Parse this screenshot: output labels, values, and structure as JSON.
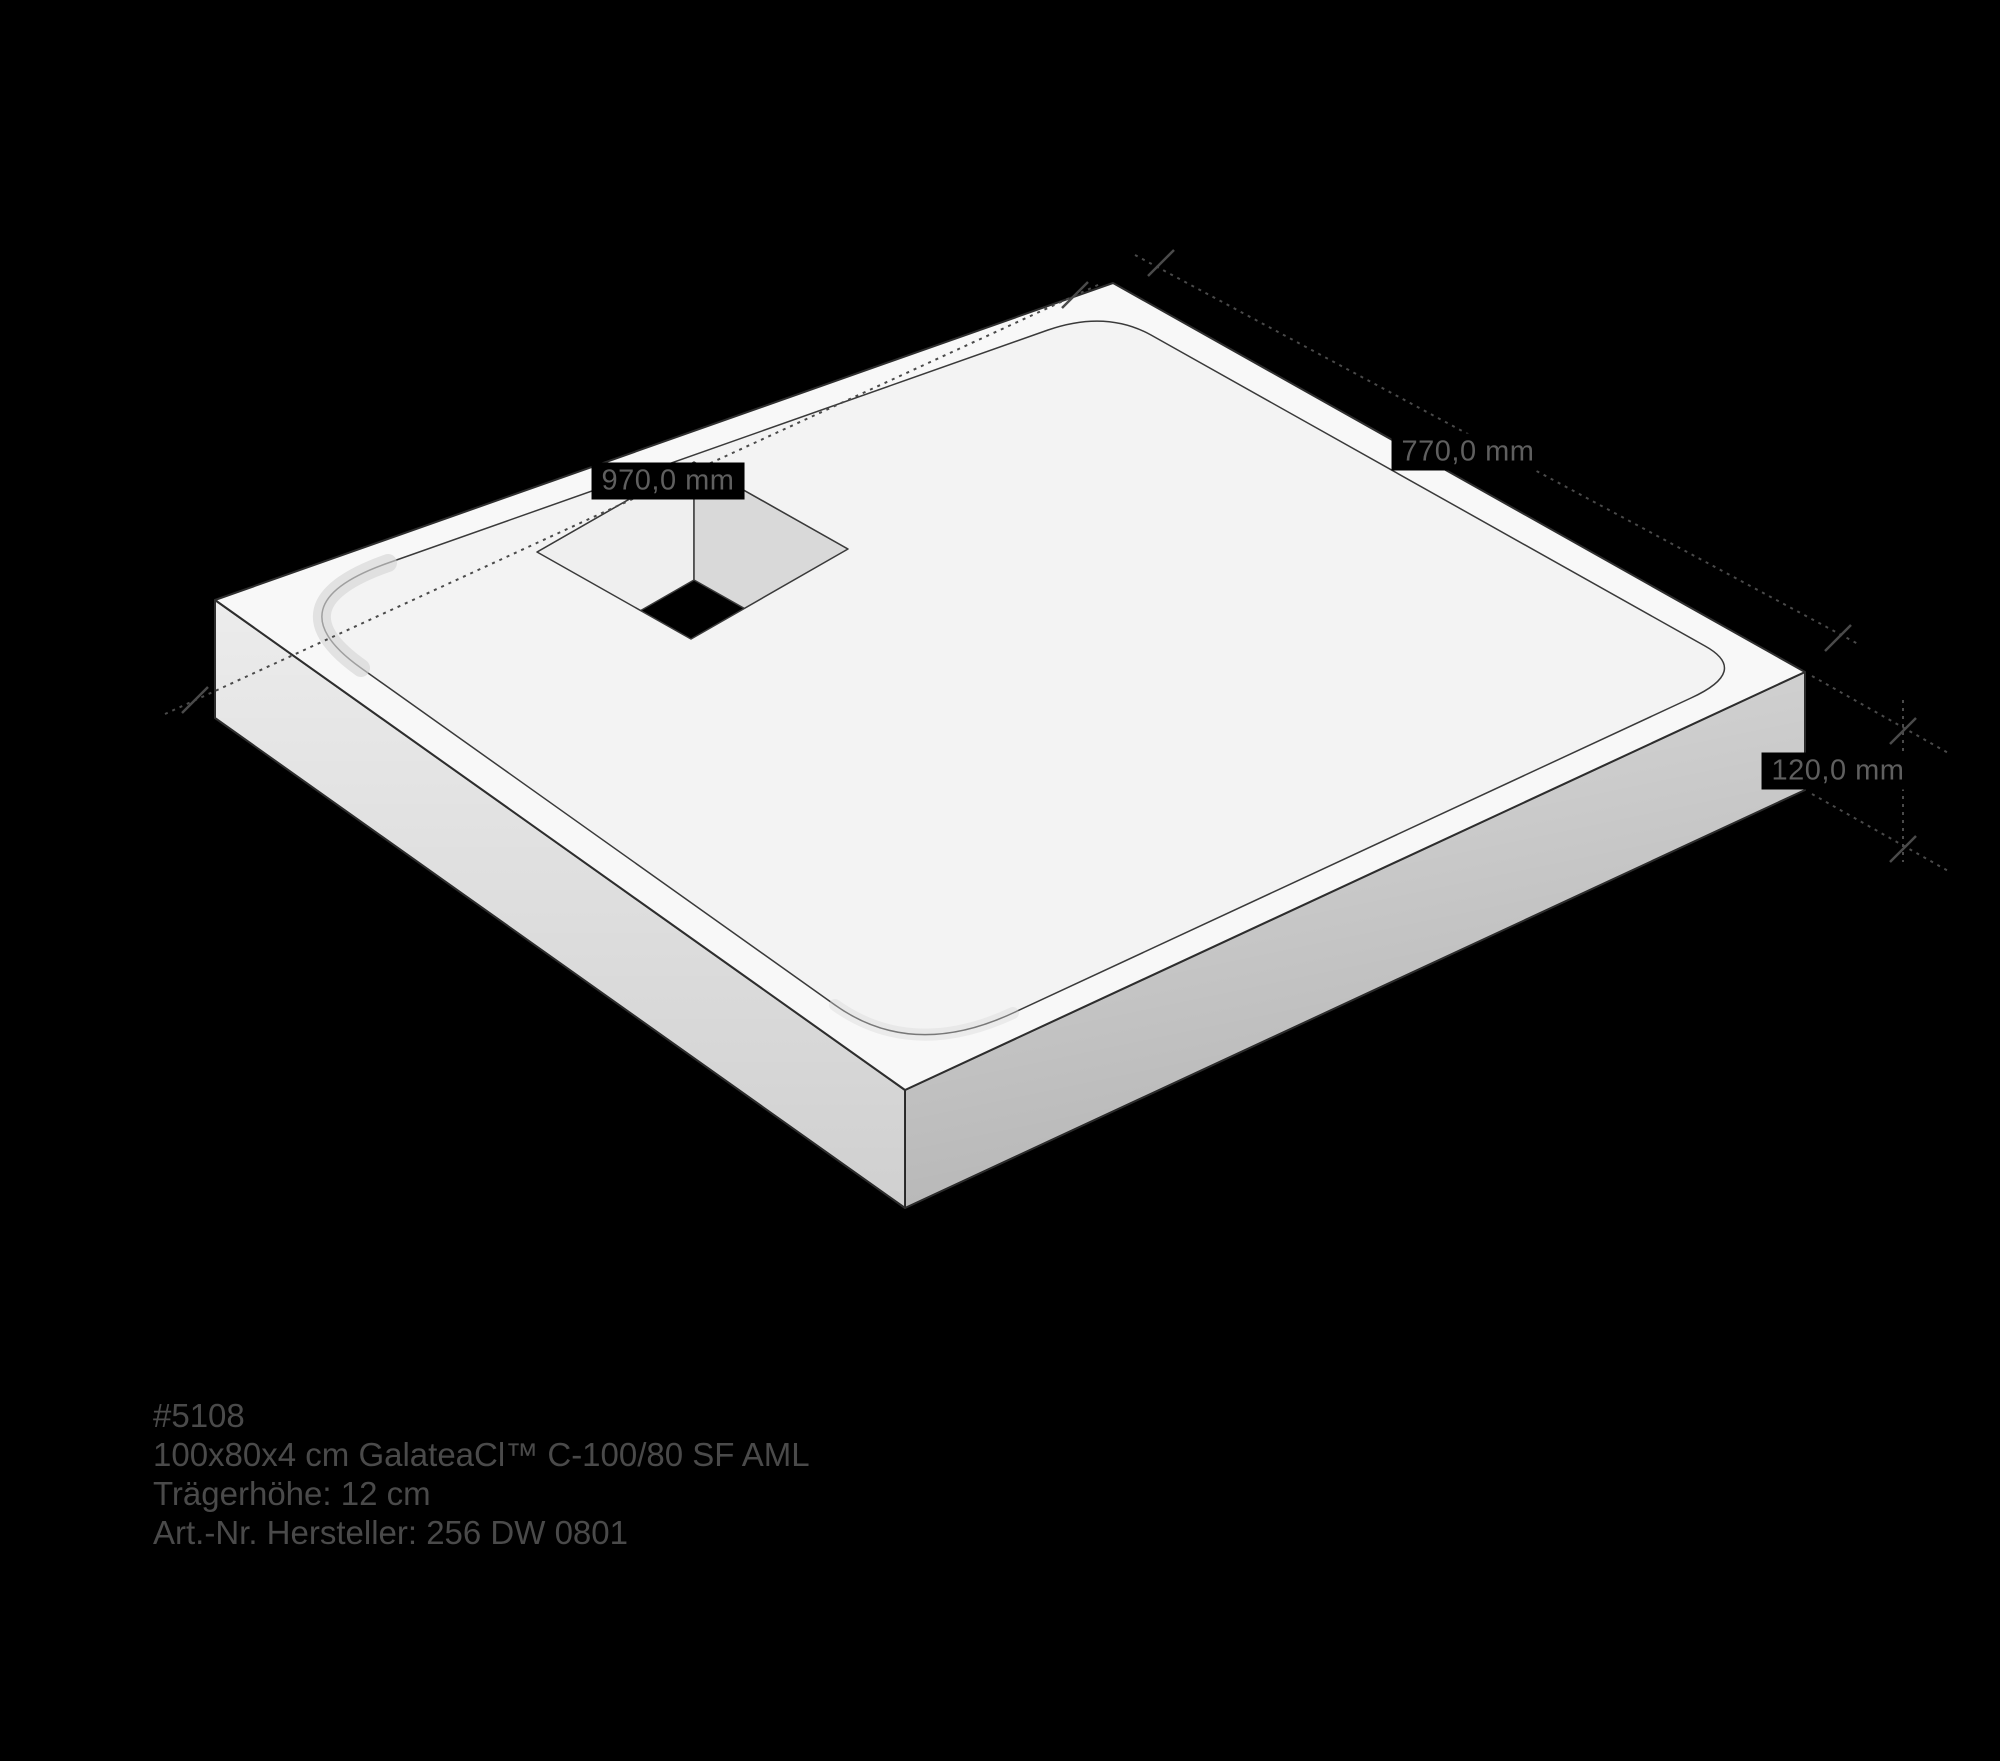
{
  "colors": {
    "background": "#000000",
    "top_face": "#f8f8f8",
    "floor": "#f3f3f3",
    "side_left": "#ececec",
    "side_right": "#dcdcdc",
    "hole_wall_left": "#efefef",
    "hole_wall_right": "#d9d9d9",
    "outline": "#2e2e2e",
    "dimension_lines": "#4a4a4a",
    "dimension_text": "#5f5f5f",
    "product_text": "#4a4a4a"
  },
  "dimensions": [
    {
      "name": "inner-length",
      "label": "970,0 mm"
    },
    {
      "name": "inner-width",
      "label": "770,0 mm"
    },
    {
      "name": "height",
      "label": "120,0 mm"
    }
  ],
  "product_info": {
    "article_number": "#5108",
    "description": "100x80x4 cm GalateaCl™ C-100/80 SF AML",
    "carrier_height": "Trägerhöhe: 12 cm",
    "manufacturer_number": "Art.-Nr. Hersteller: 256 DW 0801"
  }
}
